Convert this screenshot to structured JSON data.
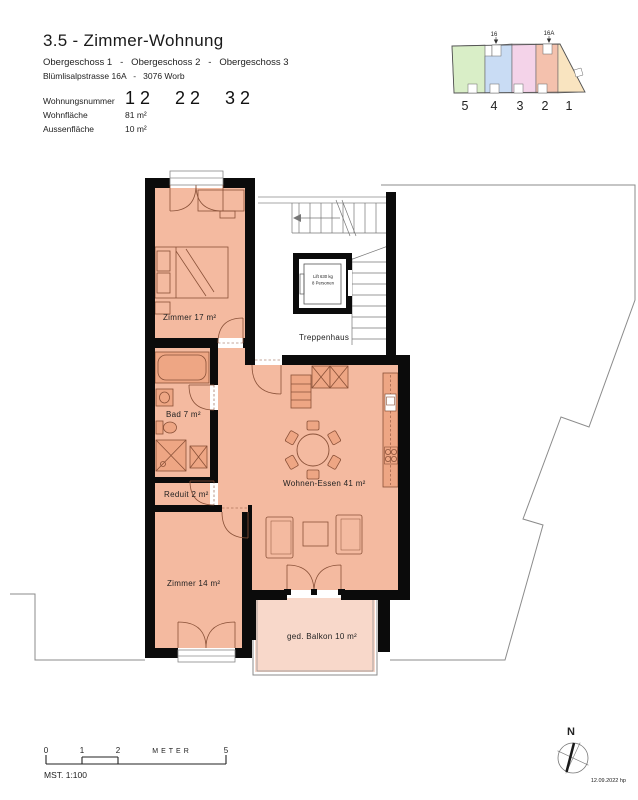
{
  "header": {
    "title": "3.5 - Zimmer-Wohnung",
    "floors": "Obergeschoss 1   -   Obergeschoss 2   -   Obergeschoss 3",
    "address": "Blümlisalpstrasse 16A   -   3076 Worb",
    "info": [
      {
        "label": "Wohnungsnummer",
        "value": "12  22  32"
      },
      {
        "label": "Wohnfläche",
        "value": "81 m²"
      },
      {
        "label": "Aussenfläche",
        "value": "10 m²"
      }
    ]
  },
  "keyplan": {
    "marker_left": "16",
    "marker_right": "16A",
    "units": [
      {
        "number": "5",
        "color": "#d9eec7"
      },
      {
        "number": "4",
        "color": "#c9dcf4"
      },
      {
        "number": "3",
        "color": "#f4d3e9"
      },
      {
        "number": "2",
        "color": "#f4c1ad"
      },
      {
        "number": "1",
        "color": "#f9e4c0"
      }
    ],
    "highlight_unit": "2"
  },
  "plan": {
    "labels": {
      "zimmer_17": "Zimmer  17 m²",
      "bad": "Bad  7 m²",
      "reduit": "Reduit  2 m²",
      "zimmer_14": "Zimmer  14 m²",
      "wohnen_essen": "Wohnen-Essen  41 m²",
      "treppenhaus": "Treppenhaus",
      "balkon": "ged. Balkon  10 m²",
      "lift_line1": "Lift  630 kg",
      "lift_line2": "8 Personen"
    },
    "colors": {
      "room_fill": "#f4baa0",
      "balcony_fill": "#f8d8ca",
      "furniture_fill": "#eea684",
      "wall": "#0b0b0b"
    }
  },
  "scalebar": {
    "tick_labels": [
      "0",
      "1",
      "2",
      "5"
    ],
    "unit_label": "METER",
    "scale_text": "MST. 1:100"
  },
  "compass": {
    "label": "N"
  },
  "footer": {
    "date_note": "12.09.2022 hp"
  }
}
